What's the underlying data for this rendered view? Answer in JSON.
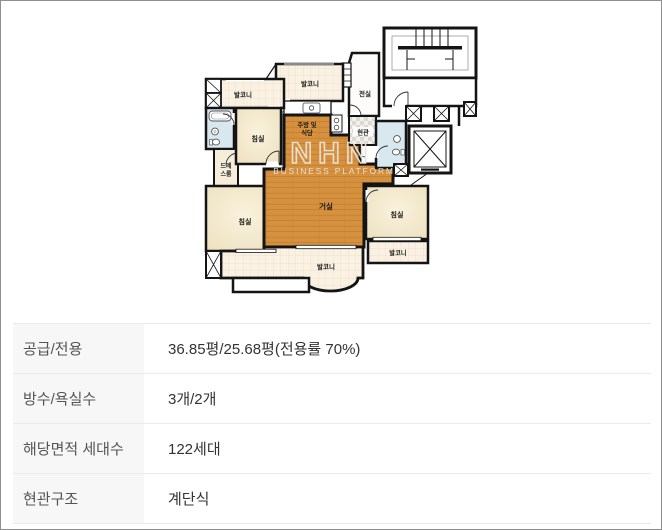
{
  "floorplan": {
    "watermark": {
      "logo": "NHN",
      "text": "BUSINESS PLATFORM"
    },
    "rooms": {
      "balcony_top_left": "발코니",
      "balcony_top": "발코니",
      "anteroom": "전실",
      "bedroom_top_left": "침실",
      "kitchen_l1": "주방 및",
      "kitchen_l2": "식당",
      "entrance": "현관",
      "dress_l1": "드레",
      "dress_l2": "스룸",
      "living": "거실",
      "bedroom_bottom_left": "침실",
      "bedroom_right": "침실",
      "balcony_bottom": "발코니",
      "balcony_bottom_right": "발코니"
    },
    "colors": {
      "wall": "#141414",
      "wood_floor": "#d6913f",
      "bedroom_floor": "#f3e8ca",
      "balcony_tile": "#faf1e2",
      "bathroom": "#d7e8ee"
    }
  },
  "table": {
    "rows": [
      {
        "label": "공급/전용",
        "value": "36.85평/25.68평(전용률 70%)"
      },
      {
        "label": "방수/욕실수",
        "value": "3개/2개"
      },
      {
        "label": "해당면적 세대수",
        "value": "122세대"
      },
      {
        "label": "현관구조",
        "value": "계단식"
      }
    ]
  }
}
